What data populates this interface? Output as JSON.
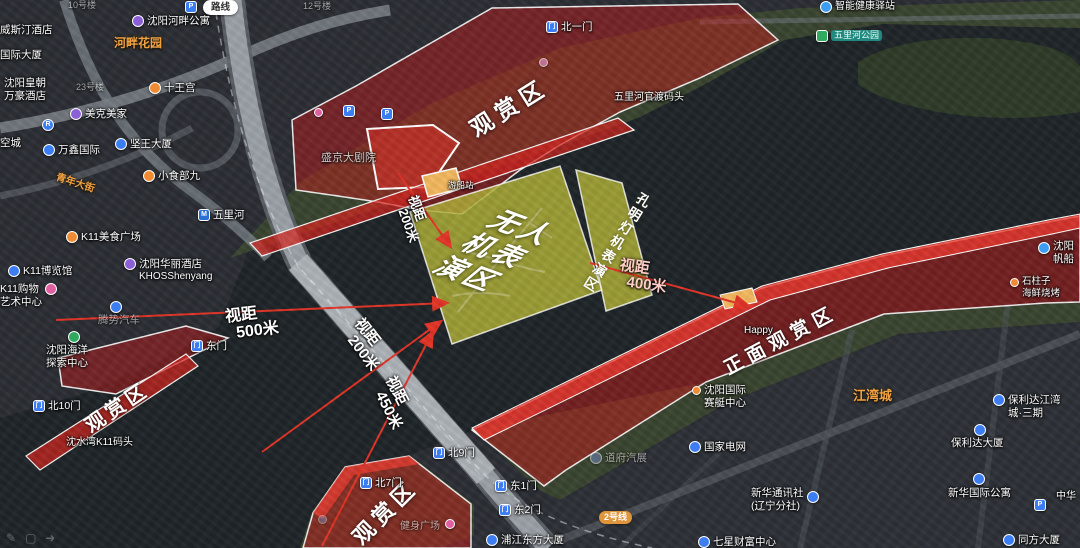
{
  "zones": {
    "north": {
      "label": "观赏区"
    },
    "west": {
      "label": "观赏区"
    },
    "south": {
      "label": "观赏区"
    },
    "front": {
      "label": "正面观赏区"
    },
    "drone": {
      "l1": "无人",
      "l2": "机表",
      "l3": "演区"
    },
    "lantern": {
      "label": "孔明灯机表演区"
    }
  },
  "distances": {
    "top200": {
      "l1": "视距",
      "l2": "200米"
    },
    "d500": {
      "l1": "视距",
      "l2": "500米"
    },
    "bridge200": {
      "l1": "视距",
      "l2": "200米"
    },
    "d450": {
      "l1": "视距",
      "l2": "450米"
    },
    "d400": {
      "l1": "视距",
      "l2": "400米"
    }
  },
  "ui": {
    "route_button": "路线"
  },
  "icons": {
    "parking": "P",
    "metro": "M",
    "gate": "门",
    "r": "R",
    "tool_pen": "✎",
    "tool_rect": "▢",
    "tool_arrow": "➜"
  },
  "labels": {
    "bldg10": "10号楼",
    "bldg12": "12号楼",
    "bldg23": "23号楼",
    "hepan_apt": "沈阳河畔公寓",
    "hepan_garden": "河畔花园",
    "westin": "威斯汀酒店",
    "intl_tower": "国际大厦",
    "huangchao1": "沈阳皇朝",
    "huangchao2": "万豪酒店",
    "shiwanggong": "十王宫",
    "meike": "美克美家",
    "wanxin": "万鑫国际",
    "kongcheng": "空城",
    "jianwang": "坚王大厦",
    "xiaoshibu": "小食部九",
    "qingnian": "青年大街",
    "k11food": "K11美食广场",
    "k11expo": "K11博览馆",
    "k11mall1": "K11购物",
    "k11mall2": "艺术中心",
    "hotel1": "沈阳华丽酒店",
    "hotel2": "KHOSShenyang",
    "tengshi": "腾势汽车",
    "ocean1": "沈阳海洋",
    "ocean2": "探索中心",
    "wulihe": "五里河",
    "eastgate": "东门",
    "theatre": "盛京大剧院",
    "northgate1": "北一门",
    "guandu": "五里河官渡码头",
    "health": "智能健康驿站",
    "park": "五里河公园",
    "boat": "游船站",
    "northgate10": "北10门",
    "k11pier": "沈水湾K11码头",
    "northgate7": "北7门",
    "northgate9": "北9门",
    "fitness": "健身广场",
    "eastgate1": "东1门",
    "eastgate2": "东2门",
    "pujiang": "浦江东方大厦",
    "line2": "2号线",
    "rowing1": "沈阳国际",
    "rowing2": "赛艇中心",
    "happy": "Happy",
    "daofu": "道府汽展",
    "grid": "国家电网",
    "xinhua1": "新华通讯社",
    "xinhua2": "(辽宁分社)",
    "qixing": "七星财富中心",
    "jiangwan": "江湾城",
    "baolida1": "保利达江湾",
    "baolida2": "城·三期",
    "baolida_tower": "保利达大厦",
    "xinhua_apt": "新华国际公寓",
    "zhonghua": "中华",
    "tongfang": "同方大厦",
    "sailing1": "沈阳",
    "sailing2": "帆船",
    "bbq1": "石柱子",
    "bbq2": "海鲜烧烤"
  },
  "colors": {
    "zone_red": "#c62222",
    "zone_red_bright": "#ee3c30",
    "drone_zone": "#afaf37",
    "arrow_red": "#e23326",
    "pier_orange": "#f2b75e",
    "label_orange": "#f0a245",
    "river": "#1e2427"
  }
}
